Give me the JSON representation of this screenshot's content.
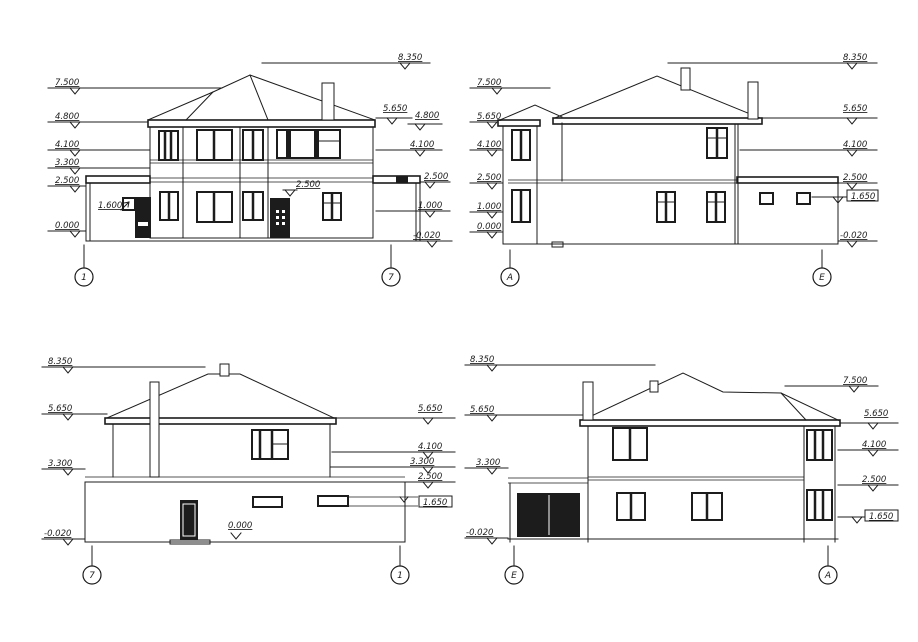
{
  "drawing": {
    "title": "building-elevations",
    "background": "#ffffff",
    "ink": "#1c1c1c"
  },
  "facades": [
    {
      "id": "elevation-1-7",
      "axes": {
        "left": "1",
        "right": "7"
      },
      "levels_left": [
        "7.500",
        "4.800",
        "4.100",
        "3.300",
        "2.500",
        "0.000"
      ],
      "levels_right": [
        "8.350",
        "5.650",
        "4.800",
        "4.100",
        "2.500",
        "1.000",
        "-0.020"
      ],
      "notes": [
        "1.600",
        "2.500"
      ]
    },
    {
      "id": "elevation-A-E",
      "axes": {
        "left": "А",
        "right": "Е"
      },
      "levels_left": [
        "7.500",
        "5.650",
        "4.100",
        "2.500",
        "1.000",
        "0.000"
      ],
      "levels_right": [
        "8.350",
        "5.650",
        "4.100",
        "2.500",
        "1.650",
        "-0.020"
      ]
    },
    {
      "id": "elevation-7-1",
      "axes": {
        "left": "7",
        "right": "1"
      },
      "levels_left": [
        "8.350",
        "5.650",
        "3.300",
        "-0.020"
      ],
      "levels_right": [
        "5.650",
        "4.100",
        "3.300",
        "2.500",
        "1.650"
      ],
      "notes": [
        "0.000"
      ]
    },
    {
      "id": "elevation-E-A",
      "axes": {
        "left": "Е",
        "right": "А"
      },
      "levels_left": [
        "8.350",
        "5.650",
        "3.300",
        "-0.020"
      ],
      "levels_right": [
        "7.500",
        "5.650",
        "4.100",
        "2.500",
        "1.650"
      ]
    }
  ]
}
